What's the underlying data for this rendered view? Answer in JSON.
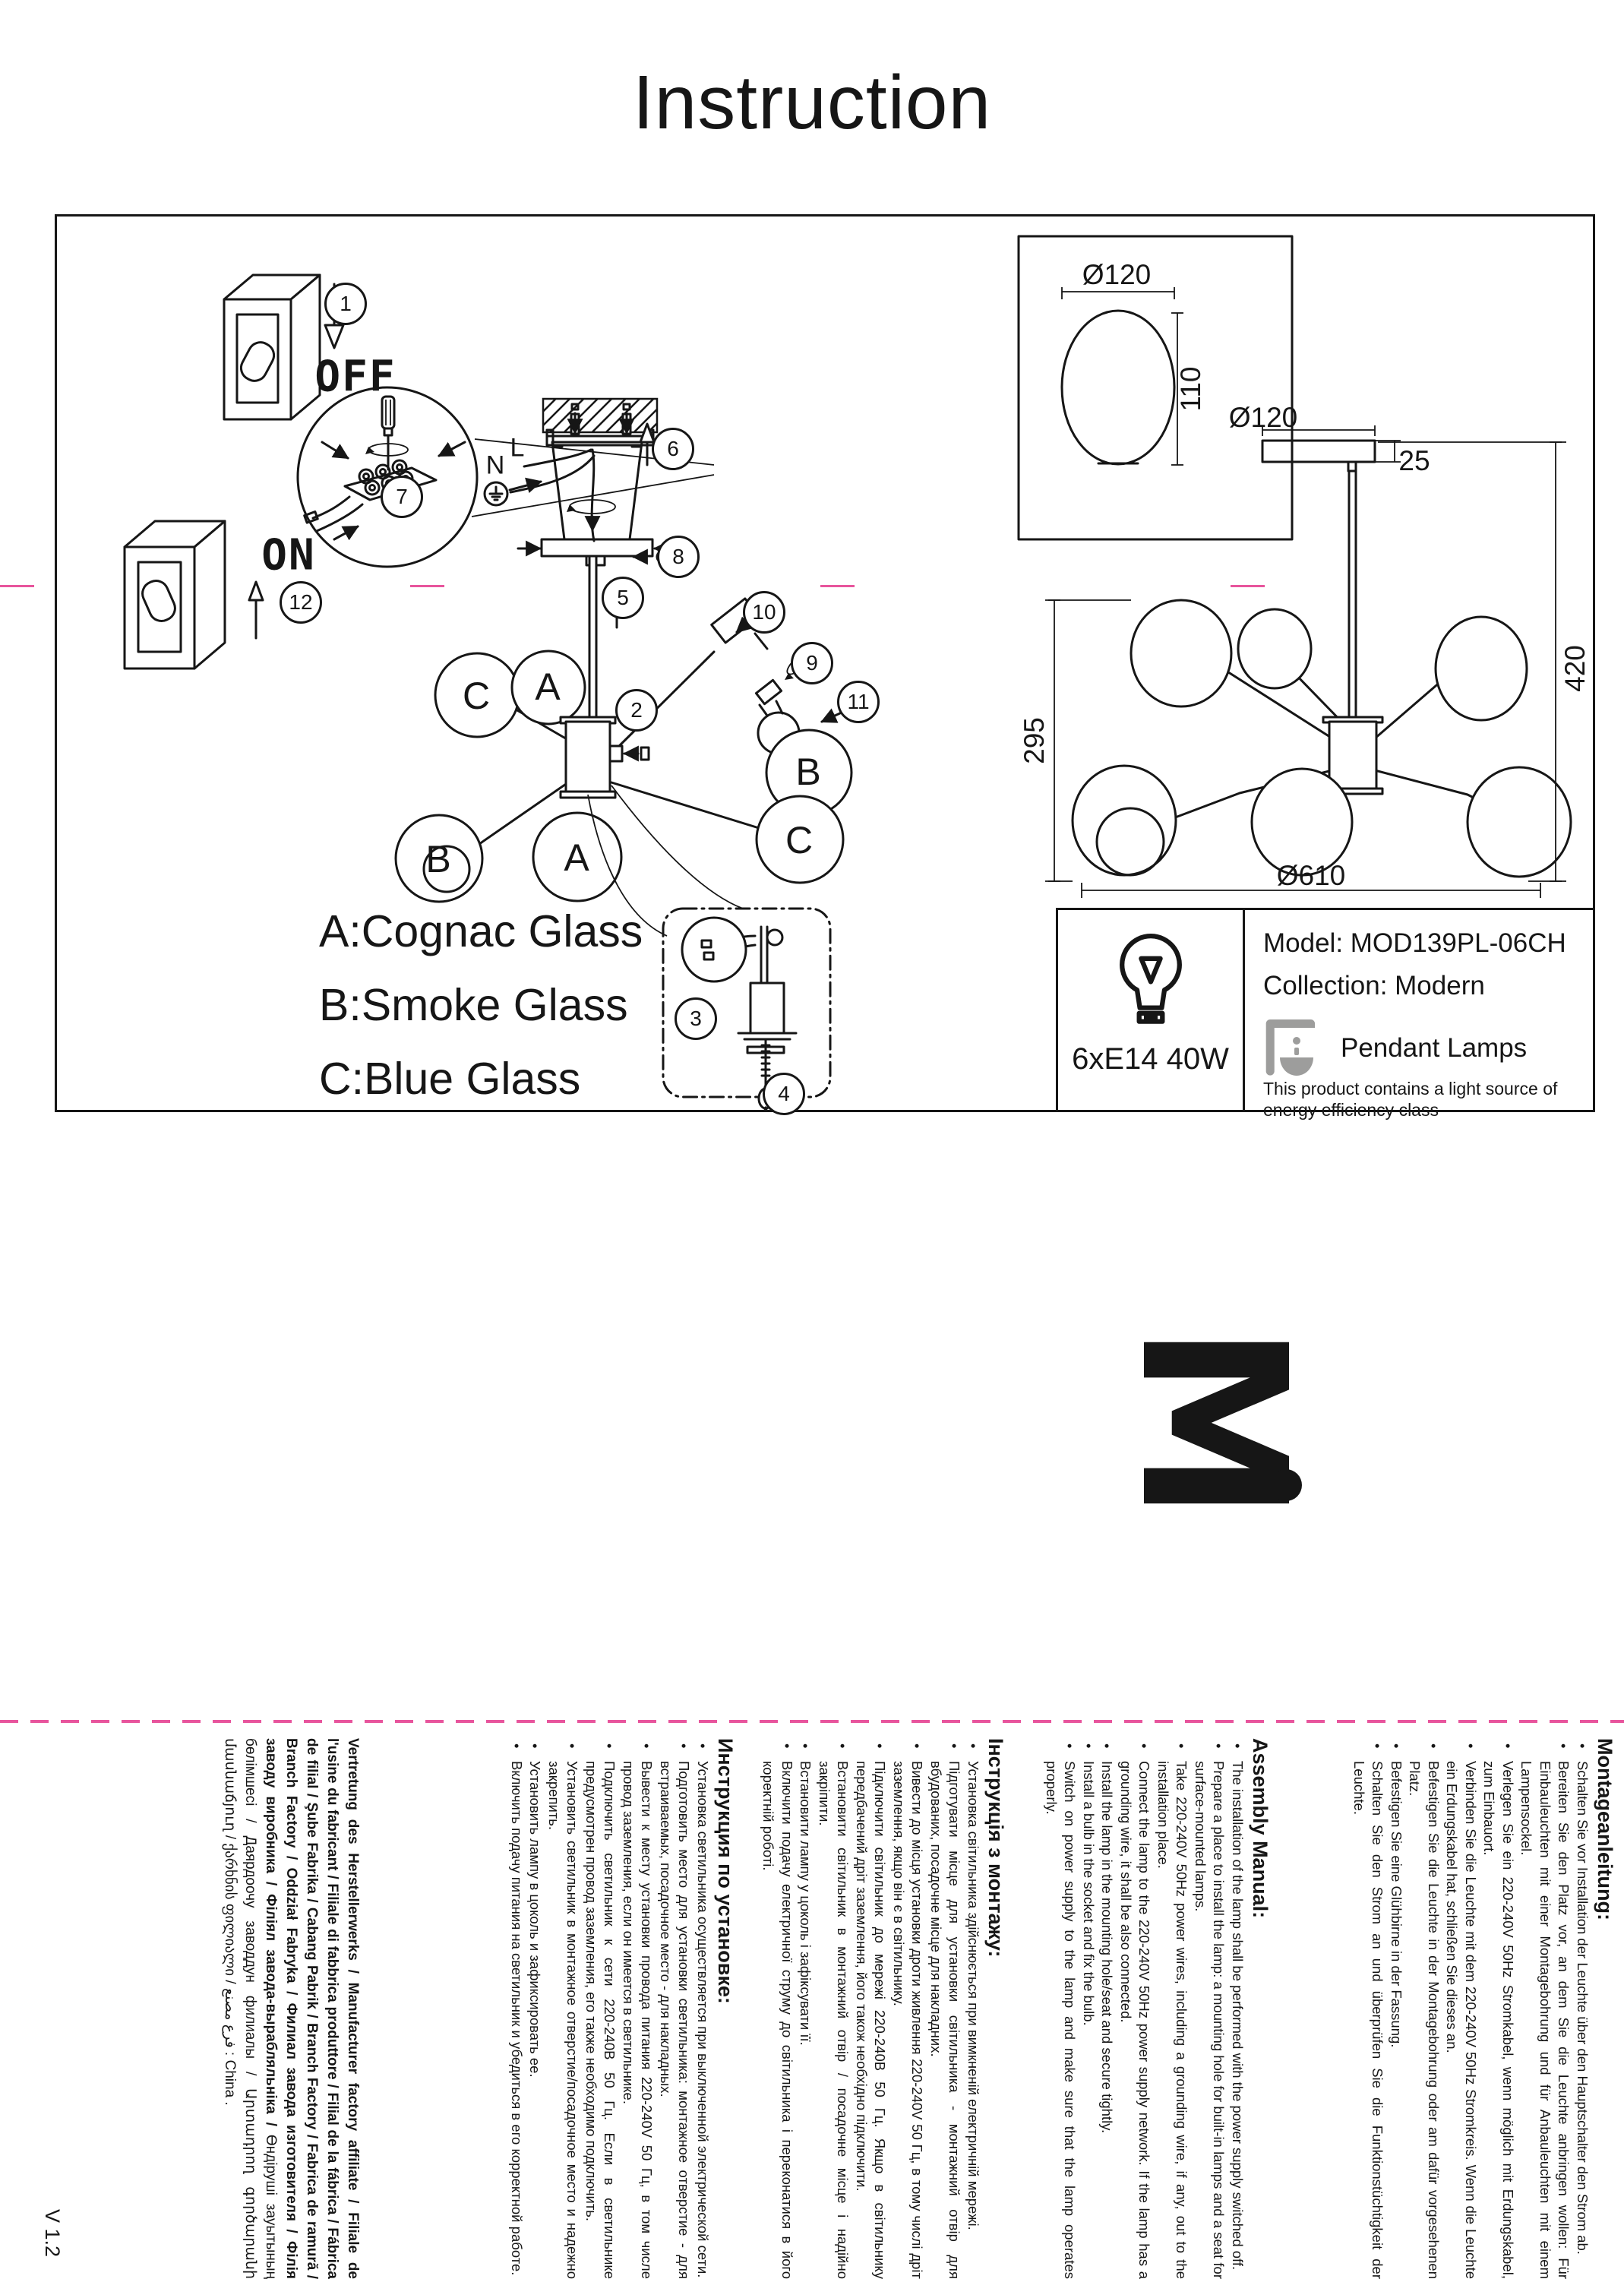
{
  "page": {
    "title": "Instruction",
    "version": "V 1.2"
  },
  "diagram": {
    "off_label": "OFF",
    "on_label": "ON",
    "wire_neutral": "N",
    "wire_live": "L",
    "legend": [
      "A:Cognac Glass",
      "B:Smoke Glass",
      "C:Blue Glass"
    ],
    "shade_labels": [
      "C",
      "A",
      "B",
      "A",
      "B",
      "C"
    ],
    "steps": [
      "1",
      "2",
      "3",
      "4",
      "5",
      "6",
      "7",
      "8",
      "9",
      "10",
      "11",
      "12"
    ],
    "dimensions": {
      "shade_d": "Ø120",
      "shade_h": "110",
      "canopy_d": "Ø120",
      "canopy_h": "25",
      "body_h": "295",
      "total_h": "420",
      "total_d": "Ø610"
    }
  },
  "spec": {
    "lamp": "6xE14 40W",
    "model": "Model: MOD139PL-06CH",
    "collection": "Collection: Modern",
    "category": "Pendant Lamps",
    "energy_note": "This product contains a light source of energy efficiency class"
  },
  "logo": {
    "mark": "M"
  },
  "icons": {
    "bulb": "bulb-icon",
    "pendant": "pendant-lamp-icon",
    "ground": "ground-icon"
  },
  "colors": {
    "ink": "#161616",
    "cut_mark": "#e8559d",
    "icon_gray": "#9d9d9c"
  },
  "sections": {
    "de": {
      "title": "Montageanleitung:",
      "bullets": [
        "Schalten Sie vor Installation der Leuchte über den Hauptschalter den Strom ab.",
        "Bereiten Sie den Platz vor, an dem Sie die Leuchte anbringen wollen: Für Einbauleuchten mit einer Montagebohrung und für Anbauleuchten mit einem Lampensockel.",
        "Verlegen Sie ein 220-240V 50Hz Stromkabel, wenn möglich mit Erdungskabel, zum Einbauort.",
        "Verbinden Sie die Leuchte mit dem 220-240V 50Hz Stromkreis. Wenn die Leuchte ein Erdungskabel hat, schließen Sie dieses an.",
        "Befestigen Sie die Leuchte in der Montagebohrung oder am dafür vorgesehenen Platz.",
        "Befestigen Sie eine Glühbirne in der Fassung.",
        "Schalten Sie den Strom an und überprüfen Sie die Funktionstüchtigkeit der Leuchte."
      ]
    },
    "en": {
      "title": "Assembly Manual:",
      "bullets": [
        "The installation of the lamp shall be performed with the power supply switched off.",
        "Prepare a place to install the lamp: a mounting hole for built-in lamps and a seat for surface-mounted lamps.",
        "Take 220-240V 50Hz power wires, including a grounding wire, if any, out to the installation place.",
        "Connect the lamp to the 220-240V 50Hz power supply network. If the lamp has a grounding wire, it shall be also connected.",
        "Install the lamp in the mounting hole/seat and secure tightly.",
        "Install a bulb in the socket and fix the bulb.",
        "Switch on power supply to the lamp and make sure that the lamp operates properly."
      ]
    },
    "uk": {
      "title": "Інструкція з монтажу:",
      "bullets": [
        "Установка світильника здійснюється при вимкненій електричній мережі.",
        "Підготувати місце для установки світильника - монтажний отвір для вбудованих, посадочне місце для накладних.",
        "Вивести до місця установки дроти живлення 220-240V 50 Гц, в тому числі дріт заземлення, якщо він є в світильнику.",
        "Підключити світильник до мережі 220-240В 50 Гц. Якщо в світильнику передбачений дріт заземлення, його також необхідно підключити.",
        "Встановити світильник в монтажний отвір / посадочне місце і надійно закріпити.",
        "Встановити лампу у цоколь і зафіксувати її.",
        "Включити подачу електричної струму до світильника і переконатися в його коректній роботі."
      ]
    },
    "ru": {
      "title": "Инструкция по установке:",
      "bullets": [
        "Установка светильника осуществляется при выключенной электрической сети.",
        "Подготовить место для установки светильника: монтажное отверстие - для встраиваемых, посадочное место - для накладных.",
        "Вывести к месту установки провода питания 220-240V 50 Гц, в том числе провод заземления, если он имеется в светильнике.",
        "Подключить светильник к сети 220-240В 50 Гц. Если в светильнике предусмотрен провод заземления, его также необходимо подключить.",
        "Установить светильник в монтажное отверстие/посадочное место и надежно закрепить.",
        "Установить лампу в цоколь и зафиксировать ее.",
        "Включить подачу питания на светильник и убедиться в его корректной работе."
      ]
    }
  },
  "manufacturer": {
    "text_bold": "Vertretung des Herstellerwerks / Manufacturer factory affiliate / Filiale de l'usine du fabricant / Filiale di fabbrica produttore / Filial de la fábrica / Fábrica de filial / Şube Fabrika / Cabang Pabrik / Branch Factory / Fabrica de ramură / Branch Factory / Oddział Fabryka / Филиал завода изготовителя / Філія заводу виробника / Філіял завода-вырабляльніка /",
    "text_regular": "Өндіруші зауытының бөлімшесі / Даярдоочу заводдун филиалы / Արտադրող գործարանի մասնաճյուղ / ქარხნის ფილიალი / فرع مصنع : China ."
  }
}
